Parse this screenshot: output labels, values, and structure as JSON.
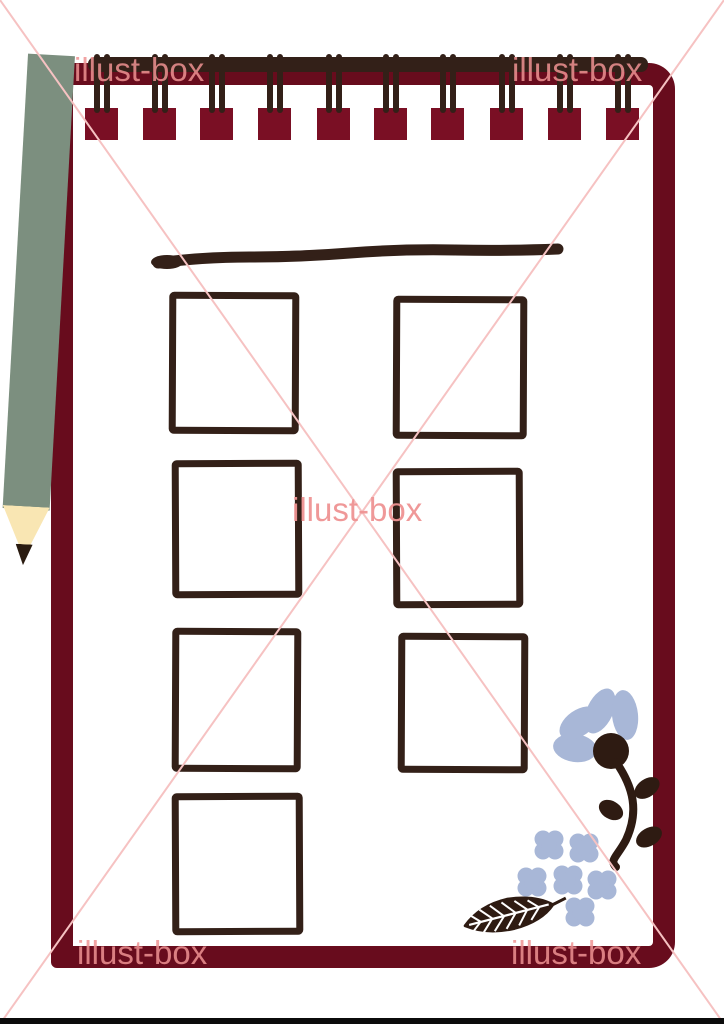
{
  "site_watermark": {
    "text": "illust-box",
    "text_color": "#ef9393",
    "diagonal_line_color": "#f6c2c2",
    "positions": [
      "top-left",
      "top-right",
      "center",
      "bottom-left",
      "bottom-right"
    ]
  },
  "illustration": {
    "subject": "spiral-bound notepad memo pad with pencil, blank hand-drawn frames and flowers",
    "binding_ring_count": 10,
    "placeholder_frame_count": 7,
    "hydrangea_flower_count": 6,
    "colors": {
      "cover_maroon": "#680c1d",
      "binding_tab_maroon": "#7a0f24",
      "ink_dark_brown": "#332018",
      "flower_blue": "#a8b7d7",
      "pencil_green": "#7c8f7f",
      "pencil_wood": "#f9e6b3",
      "pencil_lead": "#2a1b10",
      "paper_white": "#ffffff",
      "letterbox_black": "#0b0b0b"
    }
  }
}
